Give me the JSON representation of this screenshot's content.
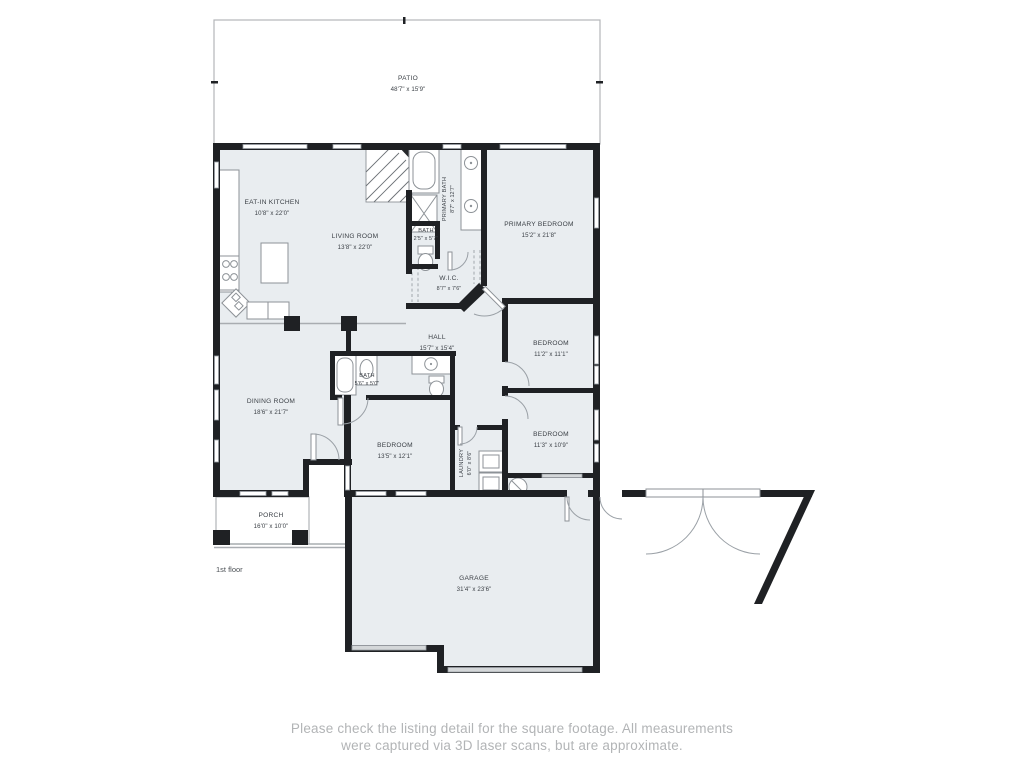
{
  "colors": {
    "wall": "#1f2124",
    "floor_fill": "#e9edf0",
    "fixture_stroke": "#8d9297",
    "outdoor_stroke": "#aeb1b4",
    "label_text": "#3a3f45",
    "footer_text": "#b2b4b6",
    "garage_door_fill": "#d4d7d9"
  },
  "floor_label": "1st floor",
  "rooms": [
    {
      "id": "patio",
      "name": "PATIO",
      "dims": "48'7\" x 15'9\""
    },
    {
      "id": "eat-in-kitchen",
      "name": "EAT-IN KITCHEN",
      "dims": "10'8\" x 22'0\""
    },
    {
      "id": "living-room",
      "name": "LIVING ROOM",
      "dims": "13'8\" x 22'0\""
    },
    {
      "id": "primary-bath",
      "name": "PRIMARY BATH",
      "dims": "8'7\" x 12'7\""
    },
    {
      "id": "bath",
      "name": "BATH",
      "dims": "2'5\" x 5'7\""
    },
    {
      "id": "primary-bedroom",
      "name": "PRIMARY BEDROOM",
      "dims": "15'2\" x 21'8\""
    },
    {
      "id": "wic",
      "name": "W.I.C.",
      "dims": "8'7\" x 7'6\""
    },
    {
      "id": "hall",
      "name": "HALL",
      "dims": "15'7\" x 15'4\""
    },
    {
      "id": "bedroom-ne",
      "name": "BEDROOM",
      "dims": "11'2\" x 11'1\""
    },
    {
      "id": "bath-2",
      "name": "BATH",
      "dims": "5'6\" x 5'0\""
    },
    {
      "id": "dining-room",
      "name": "DINING ROOM",
      "dims": "18'6\" x 21'7\""
    },
    {
      "id": "bedroom-mid",
      "name": "BEDROOM",
      "dims": "13'5\" x 12'1\""
    },
    {
      "id": "bedroom-se",
      "name": "BEDROOM",
      "dims": "11'3\" x 10'9\""
    },
    {
      "id": "laundry",
      "name": "LAUNDRY",
      "dims": "6'0\" x 8'6\""
    },
    {
      "id": "porch",
      "name": "PORCH",
      "dims": "16'0\" x 10'0\""
    },
    {
      "id": "garage",
      "name": "GARAGE",
      "dims": "31'4\" x 23'6\""
    }
  ],
  "footer": {
    "line1": "Please check the listing detail for the square footage. All measurements",
    "line2": "were captured via 3D laser scans, but are approximate."
  }
}
